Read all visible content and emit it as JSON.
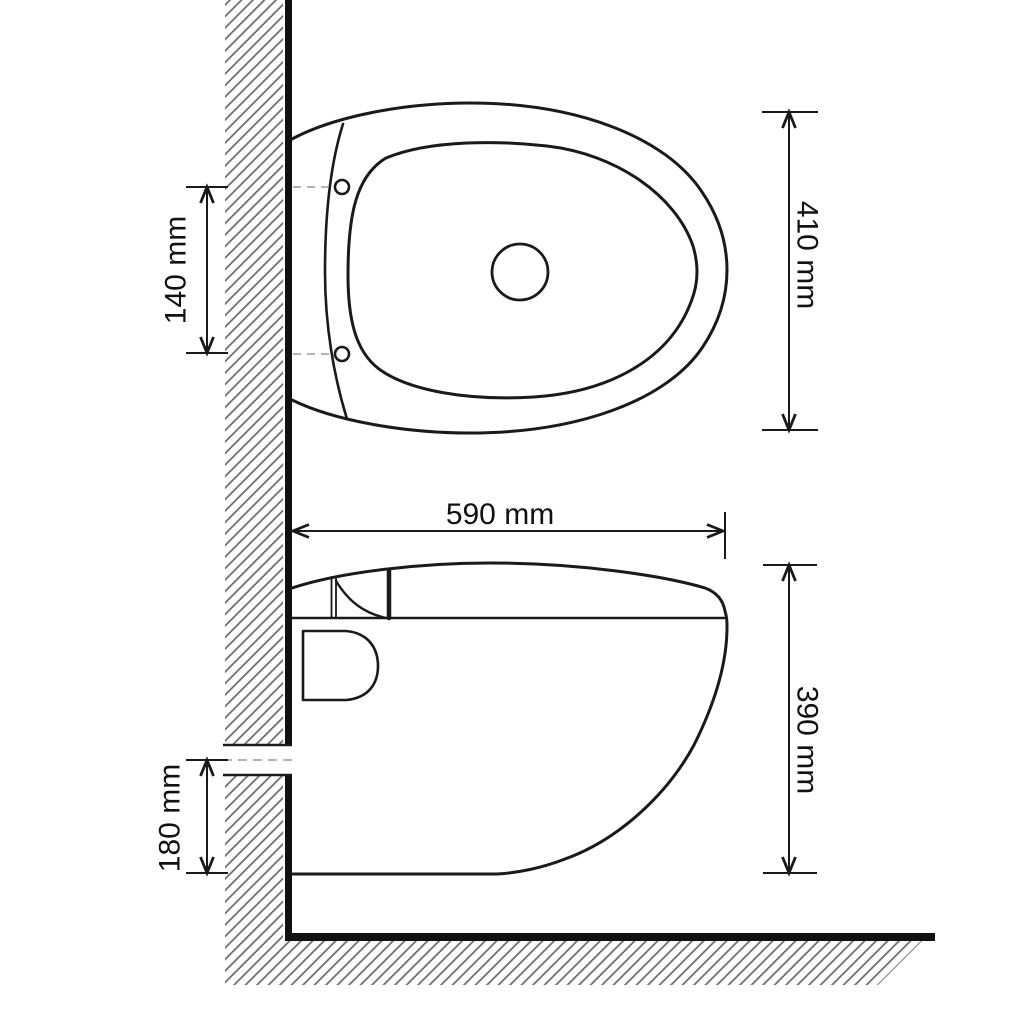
{
  "drawing": {
    "title": "wall-hung-toilet-dimension-drawing",
    "labels": {
      "hole_spacing": "140 mm",
      "seat_width": "410 mm",
      "depth": "590 mm",
      "body_height": "390 mm",
      "outlet_height": "180 mm"
    },
    "colors": {
      "line": "#1a1a1a",
      "hatch": "#707070",
      "dashed_line": "#9a9a9a",
      "background": "#ffffff"
    }
  }
}
